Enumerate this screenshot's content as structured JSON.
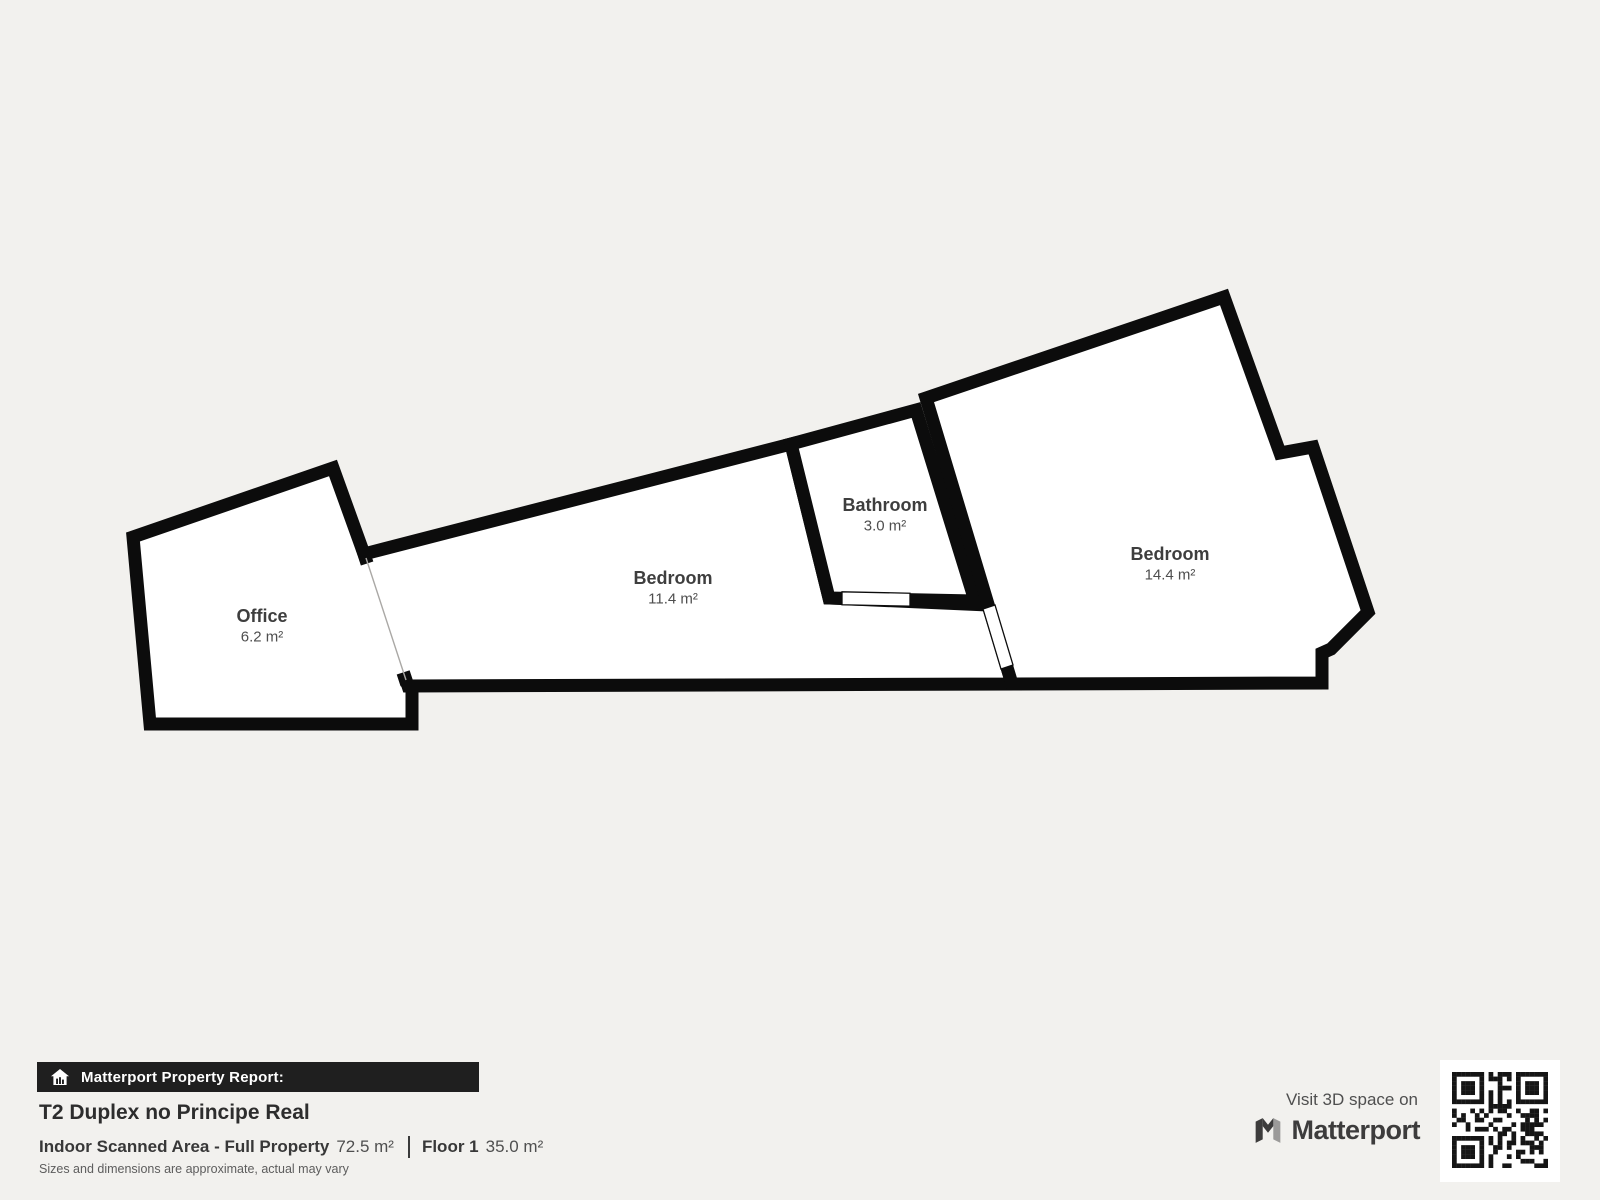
{
  "plan": {
    "background": "#f2f1ee",
    "wall_color": "#0c0c0c",
    "floor_color": "#ffffff",
    "wall_width": 13,
    "open_boundary_color": "#aaa8a5",
    "rooms": [
      {
        "name": "Office",
        "area": "6.2 m²",
        "label_x": 262,
        "label_y": 622,
        "polygon": [
          [
            133,
            537
          ],
          [
            333,
            468
          ],
          [
            364,
            554
          ],
          [
            406,
            682
          ],
          [
            412,
            686
          ],
          [
            412,
            724
          ],
          [
            150,
            724
          ]
        ]
      },
      {
        "name": "Bedroom",
        "area": "11.4 m²",
        "label_x": 673,
        "label_y": 584,
        "polygon": [
          [
            364,
            554
          ],
          [
            791,
            444
          ],
          [
            829,
            598
          ],
          [
            988,
            605
          ],
          [
            1012,
            684
          ],
          [
            408,
            686
          ]
        ]
      },
      {
        "name": "Bathroom",
        "area": "3.0 m²",
        "label_x": 885,
        "label_y": 511,
        "polygon": [
          [
            791,
            444
          ],
          [
            916,
            410
          ],
          [
            975,
            601
          ],
          [
            829,
            598
          ]
        ]
      },
      {
        "name": "Bedroom",
        "area": "14.4 m²",
        "label_x": 1170,
        "label_y": 560,
        "polygon": [
          [
            926,
            398
          ],
          [
            1224,
            297
          ],
          [
            1280,
            453
          ],
          [
            1313,
            447
          ],
          [
            1368,
            612
          ],
          [
            1331,
            649
          ],
          [
            1322,
            653
          ],
          [
            1322,
            683
          ],
          [
            1012,
            684
          ]
        ]
      }
    ],
    "open_boundary": [
      [
        364,
        554
      ],
      [
        406,
        682
      ]
    ],
    "doors": [
      [
        [
          842,
          591.8
        ],
        [
          910,
          593.2
        ],
        [
          910,
          606.2
        ],
        [
          842,
          604.8
        ]
      ],
      [
        [
          983,
          609
        ],
        [
          995,
          605
        ],
        [
          1013,
          665
        ],
        [
          1001,
          669
        ]
      ]
    ]
  },
  "report": {
    "banner_label": "Matterport Property Report:",
    "title": "T2 Duplex no Principe Real",
    "scanned_area_label": "Indoor Scanned Area - Full Property",
    "scanned_area_value": "72.5 m²",
    "floor_label": "Floor 1",
    "floor_value": "35.0 m²",
    "disclaimer": "Sizes and dimensions are approximate, actual may vary"
  },
  "cta": {
    "visit_text": "Visit 3D space on",
    "brand": "Matterport"
  },
  "icons": {
    "banner_icon": "house-report-icon",
    "brand_icon": "matterport-m-icon",
    "qr": "qr-code"
  },
  "qr": {
    "modules": 21,
    "seed": 7,
    "color": "#151515"
  }
}
